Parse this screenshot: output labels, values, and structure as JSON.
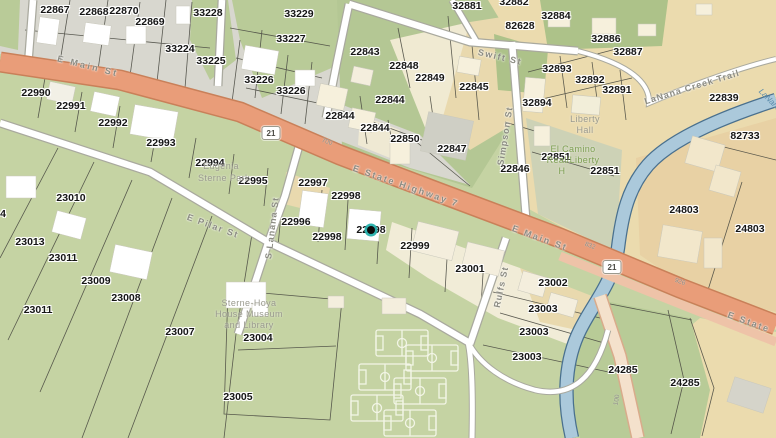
{
  "map": {
    "marker": {
      "x": 371,
      "y": 230,
      "color": "#26b0ac"
    },
    "shields": [
      {
        "text": "21",
        "x": 271,
        "y": 133
      },
      {
        "text": "21",
        "x": 612,
        "y": 267
      }
    ],
    "parcel_labels": [
      {
        "text": "22867",
        "x": 55,
        "y": 10
      },
      {
        "text": "22868",
        "x": 94,
        "y": 12
      },
      {
        "text": "22870",
        "x": 124,
        "y": 11
      },
      {
        "text": "22869",
        "x": 150,
        "y": 22
      },
      {
        "text": "33228",
        "x": 208,
        "y": 13
      },
      {
        "text": "33224",
        "x": 180,
        "y": 49
      },
      {
        "text": "33225",
        "x": 211,
        "y": 61
      },
      {
        "text": "33229",
        "x": 299,
        "y": 14
      },
      {
        "text": "33227",
        "x": 291,
        "y": 39
      },
      {
        "text": "33226",
        "x": 259,
        "y": 80
      },
      {
        "text": "33226",
        "x": 291,
        "y": 91
      },
      {
        "text": "22843",
        "x": 365,
        "y": 52
      },
      {
        "text": "22848",
        "x": 404,
        "y": 66
      },
      {
        "text": "22849",
        "x": 430,
        "y": 78
      },
      {
        "text": "22845",
        "x": 474,
        "y": 87
      },
      {
        "text": "22844",
        "x": 390,
        "y": 100
      },
      {
        "text": "22844",
        "x": 340,
        "y": 116
      },
      {
        "text": "22844",
        "x": 375,
        "y": 128
      },
      {
        "text": "22850",
        "x": 405,
        "y": 139
      },
      {
        "text": "22847",
        "x": 452,
        "y": 149
      },
      {
        "text": "32881",
        "x": 467,
        "y": 6
      },
      {
        "text": "32882",
        "x": 514,
        "y": 2
      },
      {
        "text": "32884",
        "x": 556,
        "y": 16
      },
      {
        "text": "82628",
        "x": 520,
        "y": 26
      },
      {
        "text": "32886",
        "x": 606,
        "y": 39
      },
      {
        "text": "32887",
        "x": 628,
        "y": 52
      },
      {
        "text": "32893",
        "x": 557,
        "y": 69
      },
      {
        "text": "32892",
        "x": 590,
        "y": 80
      },
      {
        "text": "32891",
        "x": 617,
        "y": 90
      },
      {
        "text": "32894",
        "x": 537,
        "y": 103
      },
      {
        "text": "22839",
        "x": 724,
        "y": 98
      },
      {
        "text": "82733",
        "x": 745,
        "y": 136
      },
      {
        "text": "22851",
        "x": 556,
        "y": 157
      },
      {
        "text": "22851",
        "x": 605,
        "y": 171
      },
      {
        "text": "22846",
        "x": 515,
        "y": 169
      },
      {
        "text": "24803",
        "x": 684,
        "y": 210
      },
      {
        "text": "24803",
        "x": 750,
        "y": 229
      },
      {
        "text": "22990",
        "x": 36,
        "y": 93
      },
      {
        "text": "22991",
        "x": 71,
        "y": 106
      },
      {
        "text": "22992",
        "x": 113,
        "y": 123
      },
      {
        "text": "22993",
        "x": 161,
        "y": 143
      },
      {
        "text": "22994",
        "x": 210,
        "y": 163
      },
      {
        "text": "22995",
        "x": 253,
        "y": 181
      },
      {
        "text": "22997",
        "x": 313,
        "y": 183
      },
      {
        "text": "22998",
        "x": 346,
        "y": 196
      },
      {
        "text": "22996",
        "x": 296,
        "y": 222
      },
      {
        "text": "22998",
        "x": 327,
        "y": 237
      },
      {
        "text": "22998",
        "x": 371,
        "y": 230
      },
      {
        "text": "22999",
        "x": 415,
        "y": 246
      },
      {
        "text": "23001",
        "x": 470,
        "y": 269
      },
      {
        "text": "23002",
        "x": 553,
        "y": 283
      },
      {
        "text": "23003",
        "x": 543,
        "y": 309
      },
      {
        "text": "23003",
        "x": 534,
        "y": 332
      },
      {
        "text": "23003",
        "x": 527,
        "y": 357
      },
      {
        "text": "23010",
        "x": 71,
        "y": 198
      },
      {
        "text": "23013",
        "x": 30,
        "y": 242
      },
      {
        "text": "23011",
        "x": 63,
        "y": 258
      },
      {
        "text": "23009",
        "x": 96,
        "y": 281
      },
      {
        "text": "23008",
        "x": 126,
        "y": 298
      },
      {
        "text": "23011",
        "x": 38,
        "y": 310
      },
      {
        "text": "23007",
        "x": 180,
        "y": 332
      },
      {
        "text": "23004",
        "x": 258,
        "y": 338
      },
      {
        "text": "23005",
        "x": 238,
        "y": 397
      },
      {
        "text": "24285",
        "x": 623,
        "y": 370
      },
      {
        "text": "24285",
        "x": 685,
        "y": 383
      },
      {
        "text": "4",
        "x": 3,
        "y": 214
      }
    ],
    "street_labels": [
      {
        "text": "E Main St",
        "x": 88,
        "y": 66,
        "rot": 14,
        "sp": 2.5
      },
      {
        "text": "E State Highway 7",
        "x": 406,
        "y": 186,
        "rot": 19,
        "sp": 2
      },
      {
        "text": "E Main St",
        "x": 540,
        "y": 238,
        "rot": 20,
        "sp": 2
      },
      {
        "text": "E State",
        "x": 749,
        "y": 322,
        "rot": 20,
        "sp": 2
      },
      {
        "text": "E Pilar St",
        "x": 213,
        "y": 226,
        "rot": 20,
        "sp": 1.5
      },
      {
        "text": "S Lanana St",
        "x": 272,
        "y": 228,
        "rot": -83,
        "sp": 1
      },
      {
        "text": "Simpson St",
        "x": 505,
        "y": 136,
        "rot": -81,
        "sp": 1
      },
      {
        "text": "Rulfs St",
        "x": 501,
        "y": 287,
        "rot": -78,
        "sp": 1
      },
      {
        "text": "Swift St",
        "x": 500,
        "y": 57,
        "rot": 13,
        "sp": 1.5
      },
      {
        "text": "LaNana Creek Trail",
        "x": 692,
        "y": 87,
        "rot": -17,
        "sp": 1
      }
    ],
    "place_labels": [
      {
        "text": "Liberty",
        "x": 585,
        "y": 119
      },
      {
        "text": "Hall",
        "x": 585,
        "y": 130
      },
      {
        "text": "El Camino",
        "x": 573,
        "y": 149,
        "cls": "green"
      },
      {
        "text": "Real/Liberty",
        "x": 573,
        "y": 160,
        "cls": "green"
      },
      {
        "text": "H",
        "x": 562,
        "y": 171,
        "cls": "green"
      },
      {
        "text": "Eugenia",
        "x": 221,
        "y": 166
      },
      {
        "text": "Sterne Park",
        "x": 224,
        "y": 178
      },
      {
        "text": "Sterne-Hoya",
        "x": 249,
        "y": 303
      },
      {
        "text": "House Museum",
        "x": 249,
        "y": 314
      },
      {
        "text": "and Library",
        "x": 249,
        "y": 325
      }
    ],
    "address_labels": [
      {
        "text": "700",
        "x": 327,
        "y": 142,
        "rot": 18
      },
      {
        "text": "832",
        "x": 590,
        "y": 246,
        "rot": 20
      },
      {
        "text": "926",
        "x": 680,
        "y": 282,
        "rot": 20
      },
      {
        "text": "100",
        "x": 617,
        "y": 400,
        "rot": -80
      }
    ],
    "water_labels": [
      {
        "text": "LaNana",
        "x": 770,
        "y": 100,
        "rot": 45
      }
    ],
    "colors": {
      "highway_fill": "#e99d79",
      "highway_edge": "#c98059",
      "street_fill": "#ffffff",
      "street_edge": "#a9a99e",
      "creek_fill": "#abc9db",
      "creek_edge": "#49708e",
      "parcel_green": "#c5d3a3",
      "parcel_tan": "#ebdbae",
      "parcel_gray": "#d8d7cf",
      "parcel_cream": "#f1ecd7",
      "marker_teal": "#26b0ac"
    }
  }
}
